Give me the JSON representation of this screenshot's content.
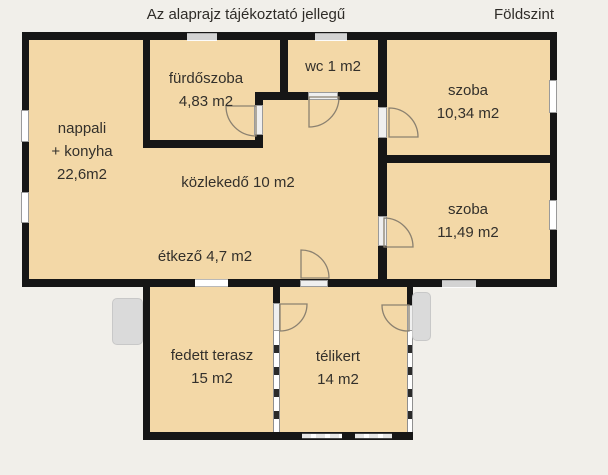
{
  "header": {
    "disclaimer": "Az alaprajz tájékoztató jellegű",
    "floor": "Földszint"
  },
  "rooms": {
    "nappali_konyha": {
      "line1": "nappali",
      "line2": "+ konyha",
      "area": "22,6m2"
    },
    "furdoszoba": {
      "name": "fürdőszoba",
      "area": "4,83 m2"
    },
    "wc": {
      "label": "wc 1 m2"
    },
    "szoba_1": {
      "name": "szoba",
      "area": "10,34 m2"
    },
    "szoba_2": {
      "name": "szoba",
      "area": "11,49 m2"
    },
    "kozlekedo": {
      "label": "közlekedő 10 m2"
    },
    "etkezo": {
      "label": "étkező 4,7 m2"
    },
    "fedett_terasz": {
      "name": "fedett terasz",
      "area": "15 m2"
    },
    "telikert": {
      "name": "télikert",
      "area": "14 m2"
    }
  },
  "colors": {
    "background": "#f1efea",
    "floor_fill": "#f3d8a7",
    "wall": "#161616",
    "window_gray": "#d3d3d3",
    "step_gray": "#dadada",
    "text": "#33302b"
  }
}
